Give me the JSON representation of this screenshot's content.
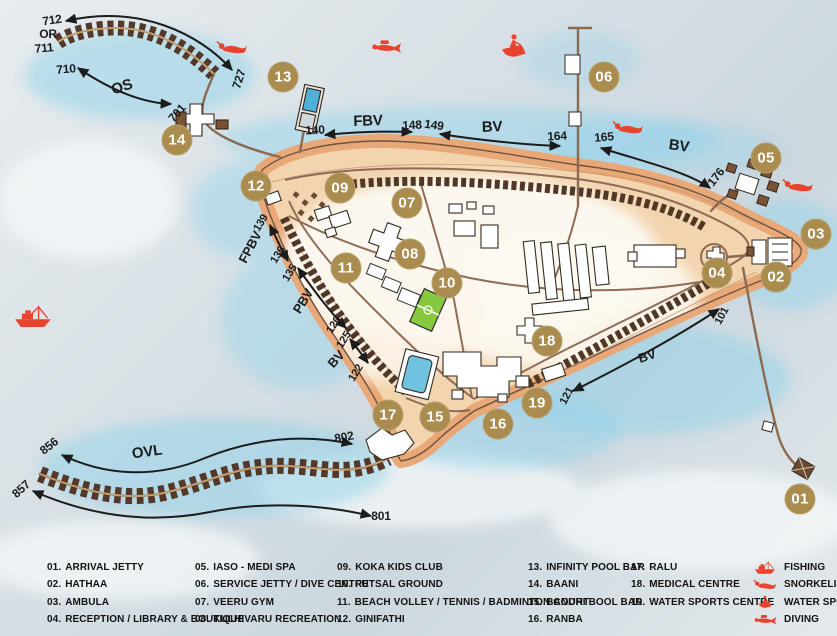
{
  "map": {
    "badges": [
      {
        "num": "01",
        "x": 800,
        "y": 499
      },
      {
        "num": "02",
        "x": 776,
        "y": 277
      },
      {
        "num": "03",
        "x": 816,
        "y": 234
      },
      {
        "num": "04",
        "x": 717,
        "y": 273
      },
      {
        "num": "05",
        "x": 766,
        "y": 158
      },
      {
        "num": "06",
        "x": 604,
        "y": 77
      },
      {
        "num": "07",
        "x": 407,
        "y": 203
      },
      {
        "num": "08",
        "x": 410,
        "y": 254
      },
      {
        "num": "09",
        "x": 340,
        "y": 188
      },
      {
        "num": "10",
        "x": 447,
        "y": 283
      },
      {
        "num": "11",
        "x": 346,
        "y": 268
      },
      {
        "num": "12",
        "x": 256,
        "y": 186
      },
      {
        "num": "13",
        "x": 283,
        "y": 77
      },
      {
        "num": "14",
        "x": 177,
        "y": 140
      },
      {
        "num": "15",
        "x": 435,
        "y": 417
      },
      {
        "num": "16",
        "x": 498,
        "y": 424
      },
      {
        "num": "17",
        "x": 388,
        "y": 415
      },
      {
        "num": "18",
        "x": 547,
        "y": 341
      },
      {
        "num": "19",
        "x": 537,
        "y": 403
      }
    ],
    "route_labels": [
      {
        "text": "712",
        "x": 52,
        "y": 20,
        "rot": -8,
        "size": 12
      },
      {
        "text": "OR",
        "x": 48,
        "y": 34,
        "rot": 0,
        "size": 12
      },
      {
        "text": "711",
        "x": 44,
        "y": 48,
        "rot": -5,
        "size": 12
      },
      {
        "text": "710",
        "x": 66,
        "y": 69,
        "rot": -5,
        "size": 12
      },
      {
        "text": "OS",
        "x": 122,
        "y": 87,
        "rot": -18,
        "size": 15
      },
      {
        "text": "701",
        "x": 177,
        "y": 113,
        "rot": -48,
        "size": 12
      },
      {
        "text": "727",
        "x": 239,
        "y": 79,
        "rot": -72,
        "size": 12
      },
      {
        "text": "140",
        "x": 315,
        "y": 130,
        "rot": -3,
        "size": 12
      },
      {
        "text": "FBV",
        "x": 368,
        "y": 121,
        "rot": -2,
        "size": 15
      },
      {
        "text": "148",
        "x": 412,
        "y": 125,
        "rot": -3,
        "size": 12
      },
      {
        "text": "149",
        "x": 434,
        "y": 125,
        "rot": 8,
        "size": 12
      },
      {
        "text": "BV",
        "x": 492,
        "y": 127,
        "rot": -2,
        "size": 15
      },
      {
        "text": "164",
        "x": 557,
        "y": 136,
        "rot": -3,
        "size": 12
      },
      {
        "text": "165",
        "x": 604,
        "y": 137,
        "rot": -5,
        "size": 12
      },
      {
        "text": "BV",
        "x": 679,
        "y": 146,
        "rot": 8,
        "size": 15
      },
      {
        "text": "176",
        "x": 716,
        "y": 177,
        "rot": -52,
        "size": 12
      },
      {
        "text": "139",
        "x": 261,
        "y": 223,
        "rot": -58,
        "size": 11
      },
      {
        "text": "FPBV",
        "x": 250,
        "y": 247,
        "rot": -62,
        "size": 13
      },
      {
        "text": "136",
        "x": 278,
        "y": 255,
        "rot": -58,
        "size": 11
      },
      {
        "text": "135",
        "x": 290,
        "y": 273,
        "rot": -58,
        "size": 11
      },
      {
        "text": "PBV",
        "x": 303,
        "y": 301,
        "rot": -58,
        "size": 13
      },
      {
        "text": "126",
        "x": 334,
        "y": 325,
        "rot": -58,
        "size": 11
      },
      {
        "text": "125",
        "x": 344,
        "y": 340,
        "rot": -58,
        "size": 11
      },
      {
        "text": "BV",
        "x": 336,
        "y": 359,
        "rot": -48,
        "size": 13
      },
      {
        "text": "122",
        "x": 356,
        "y": 373,
        "rot": -58,
        "size": 11
      },
      {
        "text": "121",
        "x": 567,
        "y": 396,
        "rot": -62,
        "size": 11
      },
      {
        "text": "BV",
        "x": 647,
        "y": 356,
        "rot": -18,
        "size": 13
      },
      {
        "text": "101",
        "x": 722,
        "y": 316,
        "rot": -62,
        "size": 11
      },
      {
        "text": "856",
        "x": 49,
        "y": 446,
        "rot": -38,
        "size": 12
      },
      {
        "text": "OVL",
        "x": 147,
        "y": 452,
        "rot": -8,
        "size": 15
      },
      {
        "text": "802",
        "x": 344,
        "y": 437,
        "rot": -10,
        "size": 12
      },
      {
        "text": "857",
        "x": 21,
        "y": 489,
        "rot": -42,
        "size": 12
      },
      {
        "text": "801",
        "x": 381,
        "y": 516,
        "rot": 0,
        "size": 12
      }
    ],
    "activity_icons": [
      {
        "icon": "snorkeling-icon",
        "x": 232,
        "y": 48,
        "w": 32,
        "h": 16
      },
      {
        "icon": "diving-icon",
        "x": 386,
        "y": 47,
        "w": 32,
        "h": 18
      },
      {
        "icon": "water-sports-icon",
        "x": 514,
        "y": 46,
        "w": 28,
        "h": 26
      },
      {
        "icon": "snorkeling-icon",
        "x": 628,
        "y": 128,
        "w": 32,
        "h": 16
      },
      {
        "icon": "snorkeling-icon",
        "x": 798,
        "y": 186,
        "w": 32,
        "h": 16
      },
      {
        "icon": "fishing-icon",
        "x": 33,
        "y": 317,
        "w": 38,
        "h": 26
      }
    ]
  },
  "legend": {
    "columns": [
      [
        {
          "num": "01.",
          "label": "ARRIVAL JETTY"
        },
        {
          "num": "02.",
          "label": "HATHAA"
        },
        {
          "num": "03.",
          "label": "AMBULA"
        },
        {
          "num": "04.",
          "label": "RECEPTION / LIBRARY & BOUTIQUE"
        }
      ],
      [
        {
          "num": "05.",
          "label": "IASO - MEDI SPA"
        },
        {
          "num": "06.",
          "label": "SERVICE JETTY / DIVE CENTRE"
        },
        {
          "num": "07.",
          "label": "VEERU GYM"
        },
        {
          "num": "08.",
          "label": "KULHIVARU RECREATION"
        }
      ],
      [
        {
          "num": "09.",
          "label": "KOKA KIDS CLUB"
        },
        {
          "num": "10.",
          "label": "FUTSAL GROUND"
        },
        {
          "num": "11.",
          "label": "BEACH VOLLEY / TENNIS / BADMINTON COURT"
        },
        {
          "num": "12.",
          "label": "GINIFATHI"
        }
      ],
      [
        {
          "num": "13.",
          "label": "INFINITY POOL BAR"
        },
        {
          "num": "14.",
          "label": "BAANI"
        },
        {
          "num": "15.",
          "label": "BANDHI BOOL BAR"
        },
        {
          "num": "16.",
          "label": "RANBA"
        }
      ],
      [
        {
          "num": "17.",
          "label": "RALU"
        },
        {
          "num": "18.",
          "label": "MEDICAL CENTRE"
        },
        {
          "num": "19.",
          "label": "WATER SPORTS CENTRE"
        }
      ]
    ],
    "activities": [
      {
        "icon": "fishing-icon",
        "label": "FISHING"
      },
      {
        "icon": "snorkeling-icon",
        "label": "SNORKELING"
      },
      {
        "icon": "water-sports-icon",
        "label": "WATER SPORTS"
      },
      {
        "icon": "diving-icon",
        "label": "DIVING"
      }
    ]
  },
  "colors": {
    "badge": "#a98c4e",
    "badge_text": "#ffffff",
    "accent_red": "#e8432f",
    "label_text": "#1c1c1c",
    "sand": "#e9a878",
    "water_wash": "#8fd2ea"
  }
}
